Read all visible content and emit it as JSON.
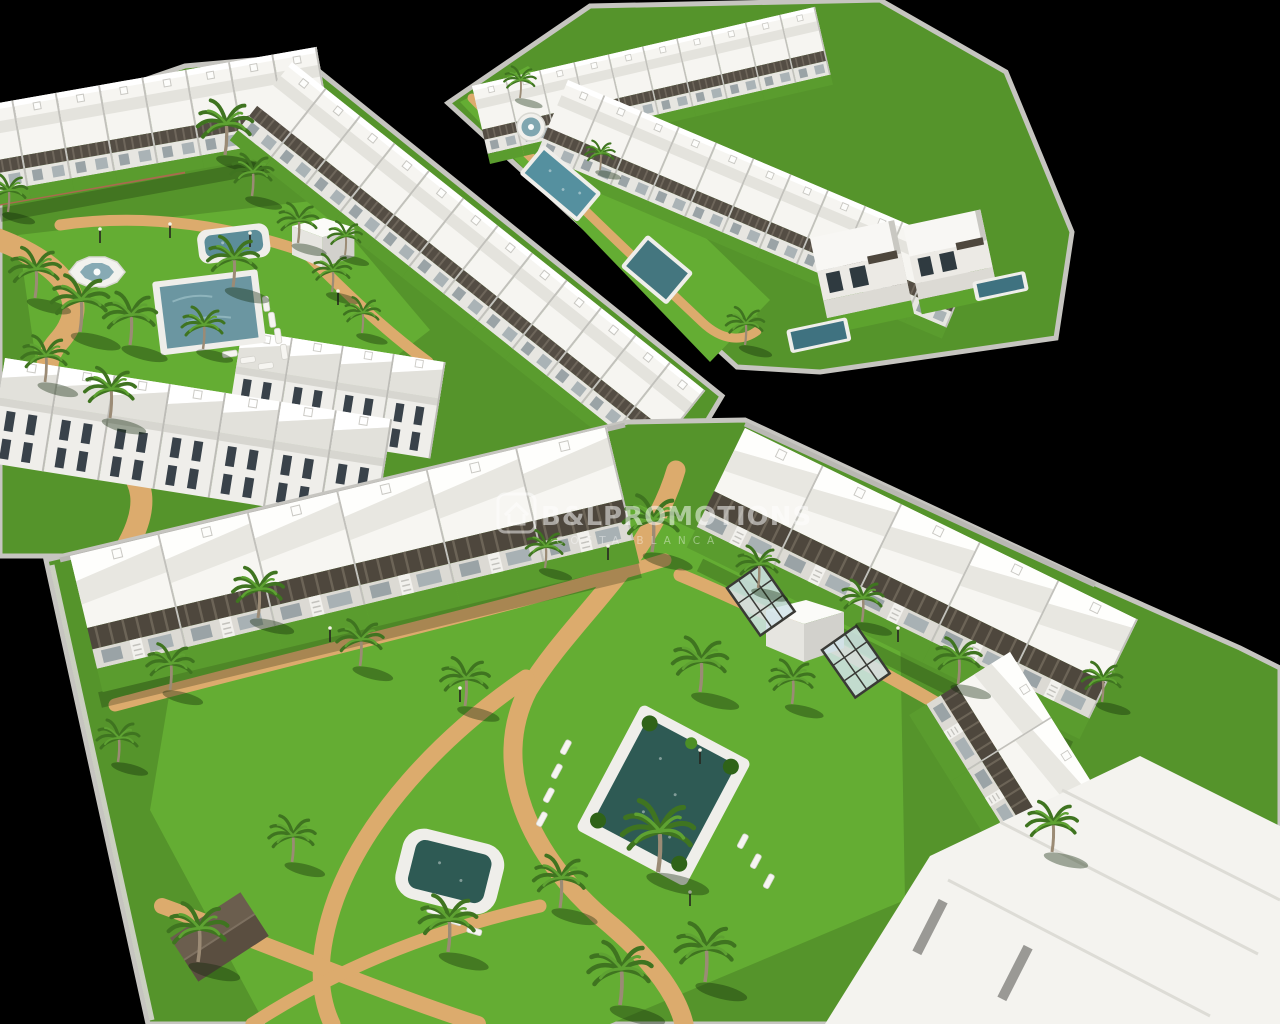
{
  "meta": {
    "title": "Aerial 3D architectural render of a Mediterranean residential development",
    "type": "architectural-visualization",
    "view": "isometric aerial"
  },
  "watermark": {
    "logo": "house-outline-icon",
    "brand": "B&LPROMOTIONS",
    "tagline": "COSTA BLANCA"
  },
  "scene": {
    "estates": [
      {
        "id": "top-left",
        "features": [
          "rows of white gabled townhouses",
          "long diagonal apartment row with dark pergola terraces",
          "three rows of townhouses with dark windows",
          "central lawn",
          "octagonal fountain",
          "children's pool",
          "main swimming pool with sun loungers",
          "palm trees",
          "sand-coloured winding paths",
          "white storage cube"
        ]
      },
      {
        "id": "top-right",
        "features": [
          "linear townhouse row",
          "second diagonal townhouse row",
          "lawn strip",
          "round fountain",
          "lap pool",
          "plunge pool",
          "two detached two-storey villas with private pools",
          "stone perimeter wall"
        ]
      },
      {
        "id": "bottom",
        "features": [
          "two long rows of two-storey apartments with dark pergolas",
          "corner apartment column",
          "large flat-roofed apartment block",
          "central garden",
          "large swimming pool with corner planters and sun loungers",
          "rounded children's pool",
          "white pool shed",
          "two glass pergola frames",
          "winding sand paths",
          "many palm trees",
          "dark timber gazebo roof",
          "street lamps"
        ]
      }
    ]
  },
  "colors": {
    "background": "#000000",
    "grass": "#55942b",
    "grassLight": "#64ad33",
    "path": "#dcab6d",
    "roof": "#f6f5f1",
    "pergola": "#4e473d",
    "wall": "#c6c5c0",
    "poolDeck": "#efeeea",
    "poolWater": "#6b96a1",
    "poolWaterDark": "#2e5a54",
    "palm": "#3f7420",
    "watermark": "#ffffff"
  }
}
